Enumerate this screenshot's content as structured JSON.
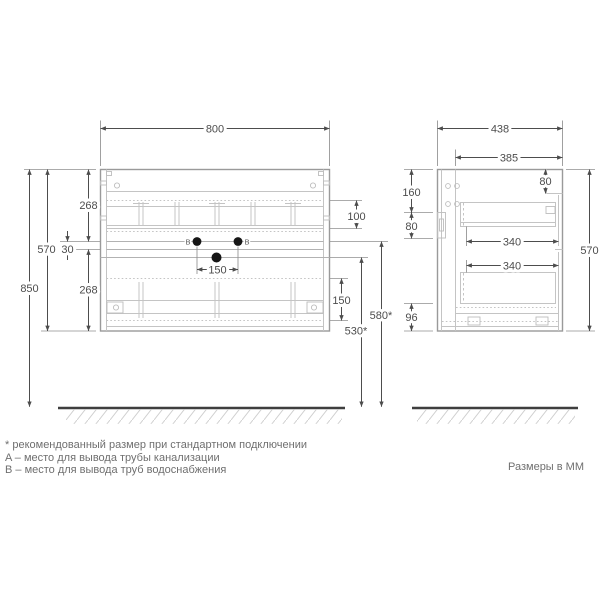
{
  "palette": {
    "background": "#ffffff",
    "drawing_line": "#c4c4c4",
    "frame_line": "#9a9a9a",
    "dimension_line": "#4d4d4d",
    "dimension_text": "#4d4d4d",
    "footnote_text": "#6f6f6f",
    "floor_line": "#3f3f3f",
    "pipe_marker_fill": "#161616"
  },
  "front_view": {
    "dim_width": "800",
    "dim_mount_height": "850",
    "dim_cabinet_height": "570",
    "dim_drawer_front_top": "268",
    "dim_gap": "30",
    "dim_drawer_front_bottom": "268",
    "dim_top_offset": "100",
    "dim_drawer_inner_height": "150",
    "dim_pipe_spacing": "150",
    "dim_water_outlet_height": "580*",
    "dim_drain_outlet_height": "530*",
    "label_b_left": "B",
    "label_b_right": "B"
  },
  "side_view": {
    "dim_depth": "438",
    "dim_inner_depth": "385",
    "dim_front_apron": "80",
    "dim_back_top_offset": "160",
    "dim_back_opening": "80",
    "dim_drawer_depth_top": "340",
    "dim_drawer_depth_bottom": "340",
    "dim_height": "570",
    "dim_bottom_clearance": "96"
  },
  "footnotes": {
    "asterisk_note": "* рекомендованный размер при стандартном подключении",
    "a_note": "A – место для вывода трубы канализации",
    "b_note": "B – место для вывода труб водоснабжения"
  },
  "units_note": "Размеры в ММ"
}
